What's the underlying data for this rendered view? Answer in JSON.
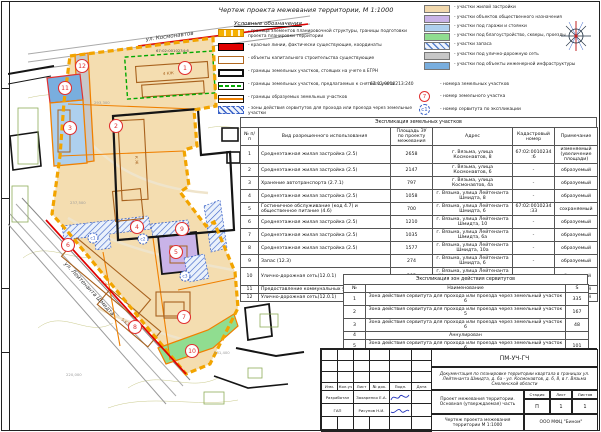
{
  "sheet_title": "Чертеж проекта межевания территории, М 1:1000",
  "legend": {
    "heading": "Условные обозначения",
    "left_items": [
      "- граница элементов планировочной структуры, границы подготовки проекта планировки территории",
      "- красные линии, фактически существующие, координаты",
      "- объекты капитального строительства существующие",
      "- границы земельных участков, стоящих на учете в ЕГРН",
      "- границы земельных участков, предлагаемых к снятию с учета",
      "- границы образуемых земельных участков",
      "- зоны действия сервитутов для прохода или проезда через земельные участки"
    ],
    "right_items": [
      "- участки жилой застройки",
      "- участки объектов общественного назначения",
      "- участки под гаражи и стоянки",
      "- участки под благоустройство, скверы, проезды",
      "- участки запаса",
      "- участки под улично-дорожную сеть",
      "- участки под объекты инженерной инфраструктуры"
    ],
    "annotations": {
      "cadastral_number": "67:02:0010213:240",
      "cadastral_label": "- номера земельных участков",
      "parcel_circle": "7",
      "parcel_label": "- номер земельного участка",
      "servitude_circle": "с1",
      "servitude_label": "- номер сервитута по экспликации"
    }
  },
  "map": {
    "street_top": "ул. Космонавтов",
    "street_bottom": "ул. Лейтенанта Шмидта",
    "cadastral_ref": "67:02:0010234:6",
    "coord_labels": [
      "293,300",
      "237,500",
      "220,000",
      "231,400"
    ],
    "parcel_numbers": [
      "1",
      "2",
      "3",
      "4",
      "5",
      "6",
      "7",
      "8",
      "9",
      "10",
      "11",
      "12"
    ],
    "servitude_numbers": [
      "с1",
      "с2",
      "с3"
    ],
    "building_labels": [
      "4 КЖ",
      "К Ж",
      "3 КЖ",
      "5 КЖ"
    ]
  },
  "parcels_table": {
    "title": "Экспликация земельных участков",
    "columns": [
      "№ п/п",
      "Вид разрешенного использования",
      "Площадь ЗУ по проекту межевания",
      "Адрес",
      "Кадастровый номер",
      "Примечание"
    ],
    "rows": [
      [
        "1",
        "Среднеэтажная жилая застройка (2.5)",
        "2658",
        "г. Вязьма, улица Космонавтов, 8",
        "67:02:0010234:6",
        "изменяемый (увеличение площади)"
      ],
      [
        "2",
        "Среднеэтажная жилая застройка (2.5)",
        "2147",
        "г. Вязьма, улица Космонавтов, 6",
        "-",
        "образуемый"
      ],
      [
        "3",
        "Хранение автотранспорта (2.7.1)",
        "797",
        "г. Вязьма, улица Космонавтов, 4а",
        "-",
        "образуемый"
      ],
      [
        "4",
        "Среднеэтажная жилая застройка (2.5)",
        "1058",
        "г. Вязьма, улица Лейтенанта Шмидта, 8",
        "-",
        "образуемый"
      ],
      [
        "5",
        "Гостиничное обслуживание (код 4.7) и общественное питание (4.6)",
        "700",
        "г. Вязьма, улица Лейтенанта Шмидта, 6",
        "67:02:0010234:33",
        "сохраняемый"
      ],
      [
        "6",
        "Среднеэтажная жилая застройка (2.5)",
        "1210",
        "г. Вязьма, улица Лейтенанта Шмидта, 10",
        "-",
        "образуемый"
      ],
      [
        "7",
        "Среднеэтажная жилая застройка (2.5)",
        "1035",
        "г. Вязьма, улица Лейтенанта Шмидта, 6а",
        "-",
        "образуемый"
      ],
      [
        "8",
        "Среднеэтажная жилая застройка (2.5)",
        "1577",
        "г. Вязьма, улица Лейтенанта Шмидта, 10а",
        "-",
        "образуемый"
      ],
      [
        "9",
        "Запас (12.3)",
        "274",
        "г. Вязьма, улица Лейтенанта Шмидта, 6",
        "-",
        "образуемый"
      ],
      [
        "10",
        "Улично-дорожная сеть(12.0.1)",
        "295",
        "г. Вязьма, улица Лейтенанта Шмидта, в районе дома 6а, 10а",
        "-",
        "образуемый"
      ],
      [
        "11",
        "Предоставление коммунальных услуг (3.1.1)",
        "300",
        "г. Вязьма, улица Космонавтов",
        "-",
        "образуемый"
      ],
      [
        "12",
        "Улично-дорожная сеть(12.0.1)",
        "427",
        "г. Вязьма, улица Космонавтов",
        "-",
        "образуемый"
      ]
    ]
  },
  "servitudes_table": {
    "title": "Экспликация зон действия сервитутов",
    "columns": [
      "№",
      "Наименование",
      "S"
    ],
    "rows": [
      [
        "1",
        "Зона действия сервитута для прохода или проезда через земельный участок 6",
        "335"
      ],
      [
        "2",
        "Зона действия сервитута для прохода или проезда через земельный участок 5",
        "167"
      ],
      [
        "3",
        "Зона действия сервитута для прохода или проезда через земельный участок 6",
        "48"
      ],
      [
        "4",
        "Аннулирован",
        ""
      ],
      [
        "5",
        "Зона действия сервитута для прохода или проезда через земельный участок 6",
        "101"
      ]
    ]
  },
  "title_block": {
    "code": "ПМ-УЧ-ГЧ",
    "description": "Документация по планировке территории квартала в границах ул. Лейтенанта Шмидта, д. 6а - ул. Космонавтов, д. 6, 8, в г. Вязьма Смоленской области",
    "col_headers": [
      "Изм.",
      "Кол.уч",
      "Лист",
      "№ док.",
      "Подп.",
      "Дата"
    ],
    "role_1": "Разработал",
    "name_1": "Захаренко Е.А.",
    "role_2": "ГАП",
    "name_2": "Рисунов Н.И.",
    "project": "Проект межевания территории. Основная (утверждаемая) часть",
    "stage_label": "Стадия",
    "sheet_label": "Лист",
    "sheets_label": "Листов",
    "stage": "П",
    "sheet": "1",
    "sheets": "1",
    "drawing_title": "Чертеж проекта межевания территории М 1:1000",
    "company": "ООО МФЦ \"Бином\""
  },
  "colors": {
    "boundary_yellow": "#f2a400",
    "red_line": "#e00000",
    "formed_boundary_orange": "#f08000",
    "egrn_black": "#151515",
    "green_dashed": "#00a800",
    "servitude_blue": "#3a62c8",
    "residential_fill": "#f2d9ae",
    "public_fill": "#c9b3e8",
    "garage_fill": "#aed0ee",
    "landscaping_fill": "#90dd90",
    "road_fill": "#c6c6c6",
    "engineering_fill": "#79aede",
    "parcel_number_red": "#e03030"
  }
}
